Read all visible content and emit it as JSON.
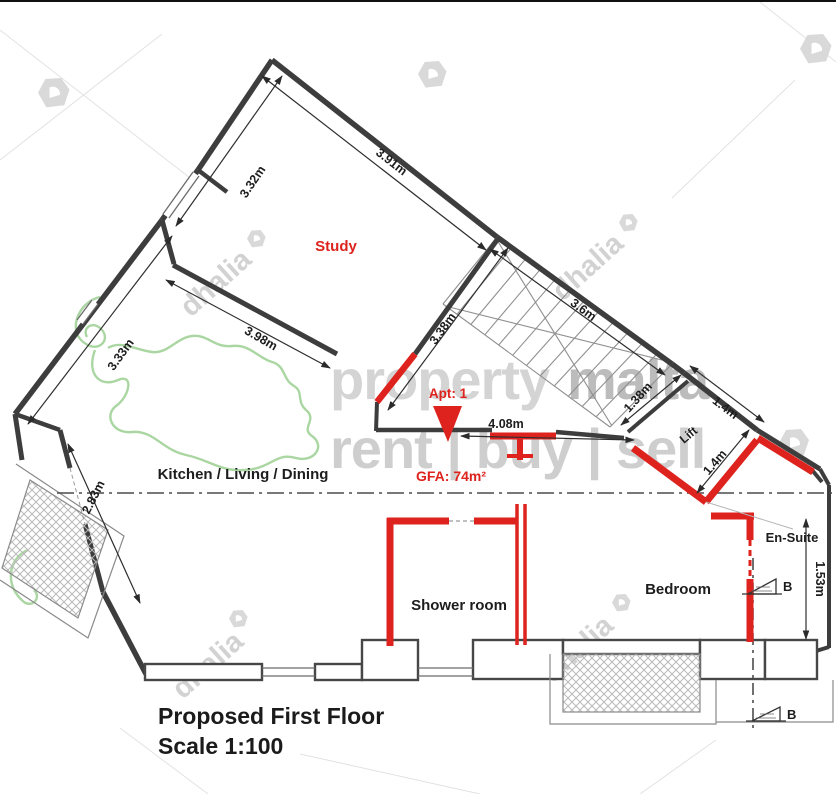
{
  "title": {
    "line1": "Proposed First Floor",
    "line2": "Scale 1:100"
  },
  "apartment": {
    "label": "Apt: 1",
    "gfa": "GFA: 74m²"
  },
  "rooms": {
    "study": "Study",
    "kitchen_living_dining": "Kitchen / Living / Dining",
    "shower_room": "Shower room",
    "bedroom": "Bedroom",
    "en_suite": "En-Suite",
    "lift": "Lift"
  },
  "dimensions": {
    "study_left_wall": "3.32m",
    "study_top_wall": "3.91m",
    "kitchen_upper_left_wall": "3.33m",
    "study_kitchen_wall": "3.98m",
    "study_stairs_wall": "3.38m",
    "stairs_outer_wall": "3.6m",
    "kitchen_lower_left_wall": "2.83m",
    "hallway_width": "4.08m",
    "lift_left": "1.38m",
    "lift_top": "1.4m",
    "lift_inner": "1.4m",
    "en_suite_depth": "1.53m"
  },
  "section_markers": {
    "b_upper": "B",
    "b_lower": "B"
  },
  "watermarks": {
    "brand_first": "property",
    "brand_second": "malta",
    "tagline": "rent | buy | sell",
    "agency": "dhalia"
  },
  "colors": {
    "highlight_red": "#de231e",
    "wall_dark": "#3d3d3d",
    "watermark_gray": "#cfcfcf",
    "logo_green": "#a8d4a0"
  }
}
